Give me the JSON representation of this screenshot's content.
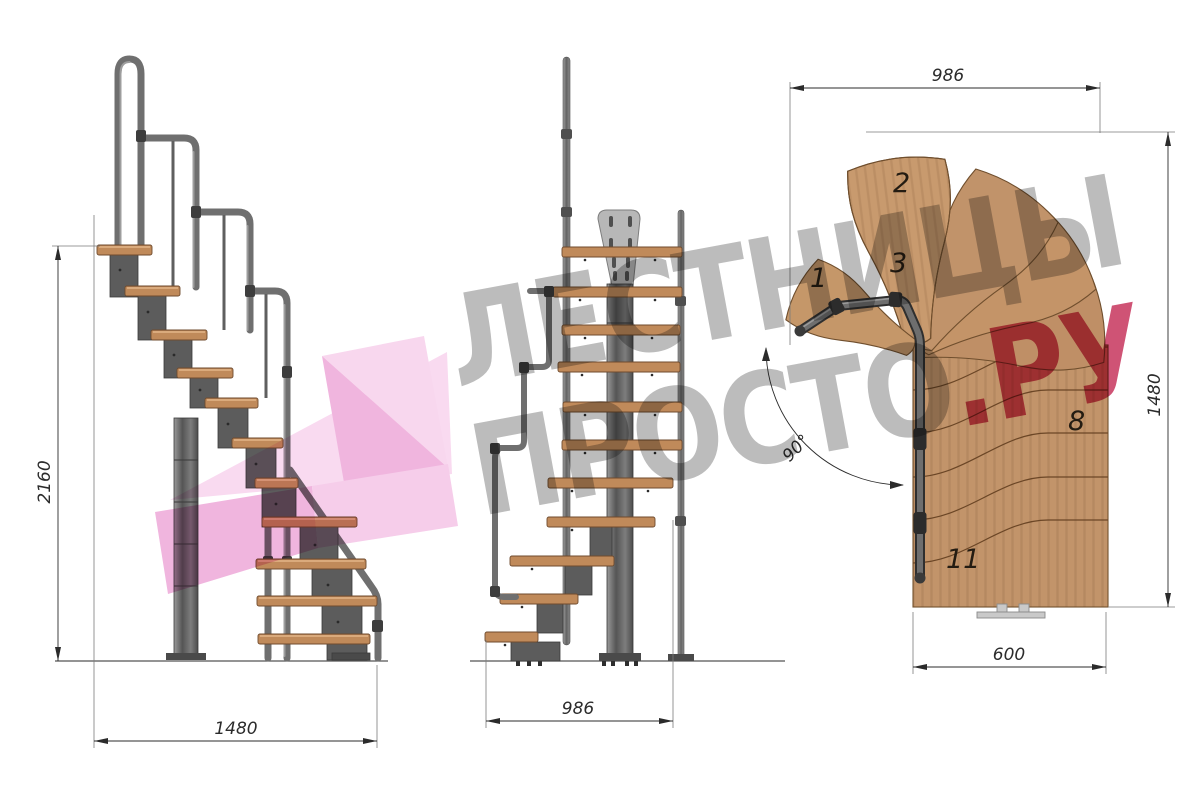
{
  "dims": {
    "side_height": "2160",
    "side_width": "1480",
    "front_width": "986",
    "plan_width": "986",
    "plan_depth": "1480",
    "plan_bottom_width": "600",
    "plan_turn_angle": "90°"
  },
  "steps": {
    "labels": [
      "1",
      "2",
      "3",
      "8",
      "11"
    ]
  },
  "watermark": {
    "brand_line1": "ЛЕСТНИЦЫ",
    "brand_line2": "ПРОСТО",
    "brand_suffix": ".РУ"
  },
  "palette": {
    "wood": "#c2946a",
    "wood_edge": "#6f4e2d",
    "tread_side": "#c08a5a",
    "metal": "#6f6f6f",
    "metal_dark": "#3d3d3d",
    "plate": "#b7b7b7",
    "dimension_line": "#2b2b2b",
    "watermark_gray": "#bcbcbc",
    "watermark_pink": "#cf5375",
    "arrow_pink": "#f0b5de",
    "arrow_pink_light": "#f9daf0"
  }
}
